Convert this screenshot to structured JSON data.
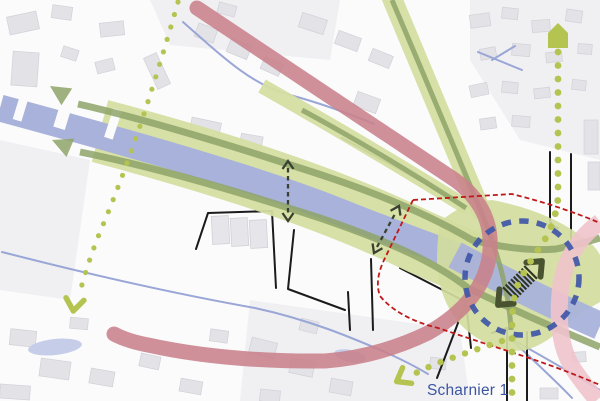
{
  "map_label": {
    "text": "Scharnier 1"
  },
  "colors": {
    "bg": "#fbfbfc",
    "block": "#f0f0f3",
    "building": "#e2e2e7",
    "building_stroke": "#d1d1d8",
    "barracks_building": "#e6e6ea",
    "street": "#1b1b1b",
    "water": "#a9b2da",
    "stream": "#99a6d6",
    "pond": "#c6cde9",
    "green_band": "#d5dea1",
    "green_line": "#8ea368",
    "junction_green": "#d3dc9e",
    "route_dot": "#b5c351",
    "pink_primary": "#c9818b",
    "pink_secondary": "#efc3cc",
    "red_dash": "#bf1a1a",
    "blue_dash": "#3f57a8",
    "cross_arrow": "#3b4132",
    "hatch_head": "#4a5330",
    "hatch_stripe": "#2f3422",
    "label": "#3c55a2"
  },
  "routes": {
    "west": {
      "spacing": 13,
      "radius": 2.6
    },
    "north_south": {
      "spacing": 13.5,
      "radius": 3.4
    },
    "southwest_spur": {
      "spacing": 13,
      "radius": 3.2
    }
  }
}
